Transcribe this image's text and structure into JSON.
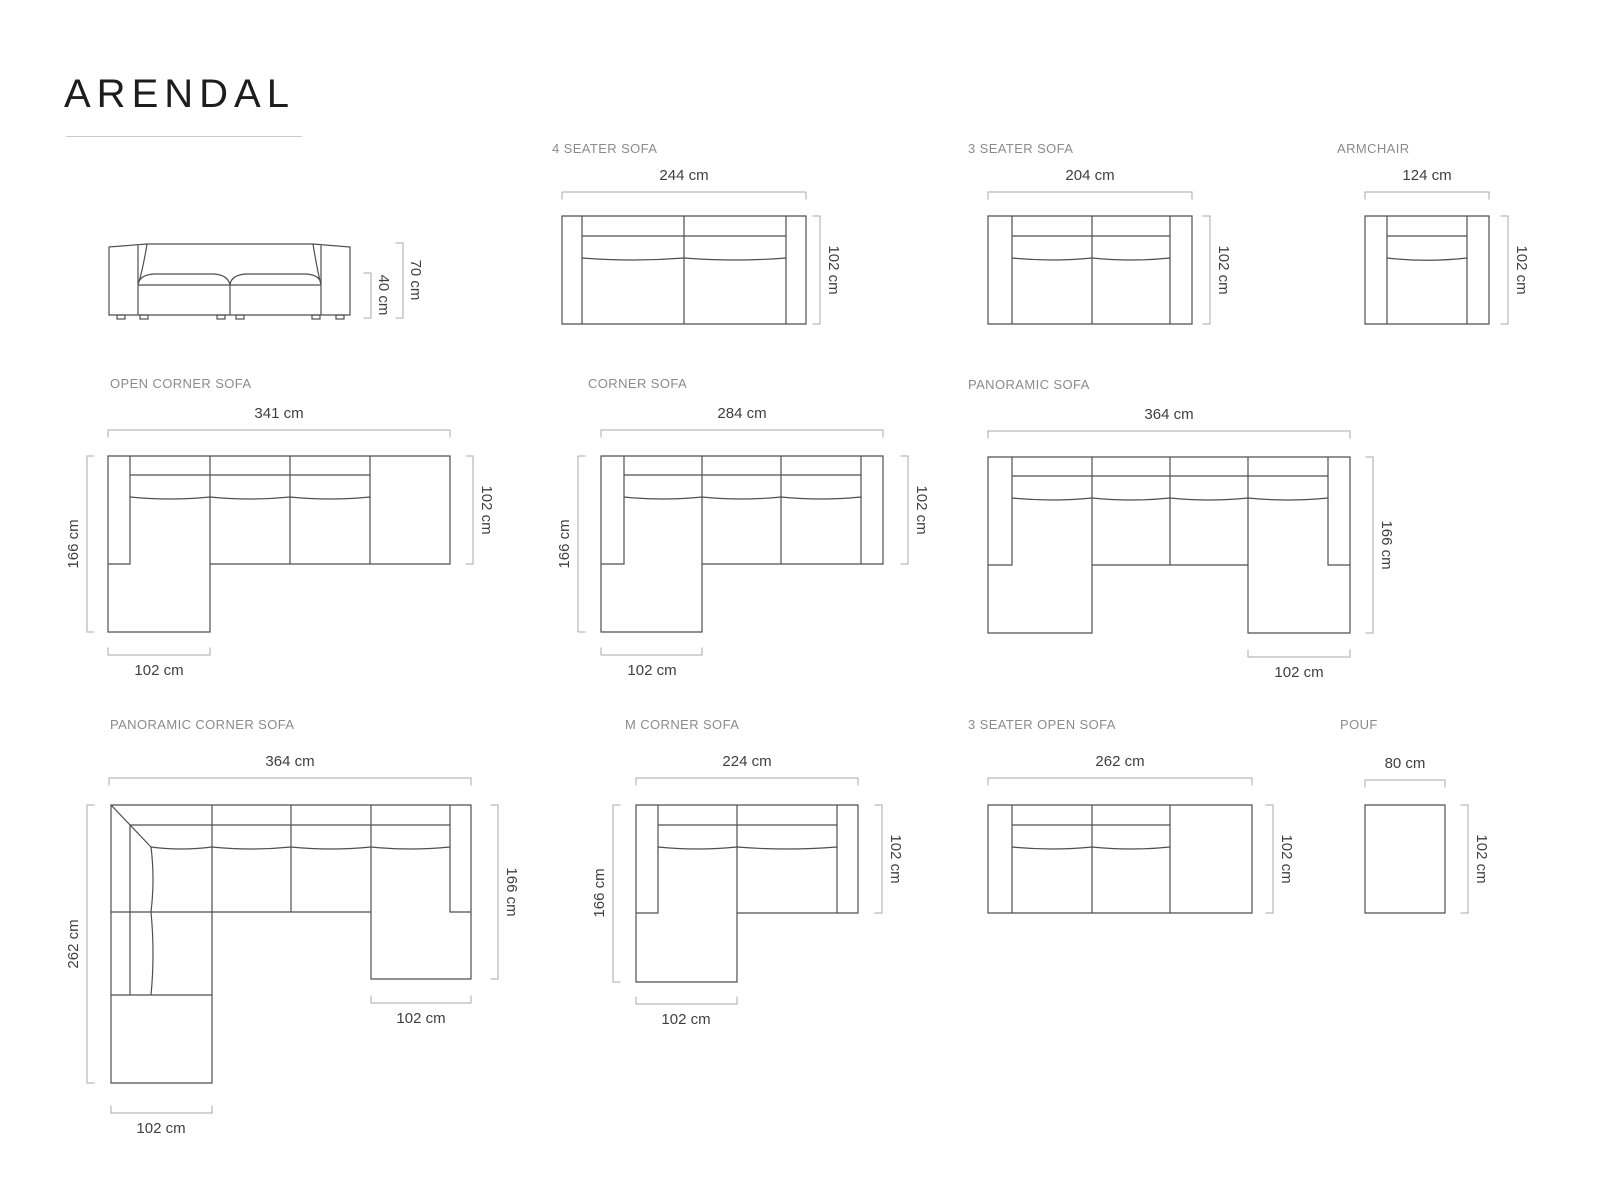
{
  "page_title": "ARENDAL",
  "diagrams": {
    "elevation": {
      "height": "70 cm",
      "seat_height": "40 cm"
    },
    "four_seater": {
      "name": "4 SEATER SOFA",
      "width": "244 cm",
      "depth": "102 cm"
    },
    "three_seater": {
      "name": "3 SEATER SOFA",
      "width": "204 cm",
      "depth": "102 cm"
    },
    "armchair": {
      "name": "ARMCHAIR",
      "width": "124 cm",
      "depth": "102 cm"
    },
    "open_corner": {
      "name": "OPEN CORNER SOFA",
      "width": "341 cm",
      "total_depth": "166 cm",
      "depth": "102 cm",
      "chaise_width": "102 cm"
    },
    "corner": {
      "name": "CORNER SOFA",
      "width": "284 cm",
      "total_depth": "166 cm",
      "depth": "102 cm",
      "chaise_width": "102 cm"
    },
    "panoramic": {
      "name": "PANORAMIC SOFA",
      "width": "364 cm",
      "total_depth": "166 cm",
      "chaise_width": "102 cm"
    },
    "panoramic_corner": {
      "name": "PANORAMIC CORNER SOFA",
      "width": "364 cm",
      "left_depth": "262 cm",
      "right_depth": "166 cm",
      "right_chaise_width": "102 cm",
      "left_chaise_width": "102 cm"
    },
    "m_corner": {
      "name": "M CORNER SOFA",
      "width": "224 cm",
      "total_depth": "166 cm",
      "depth": "102 cm",
      "chaise_width": "102 cm"
    },
    "three_seater_open": {
      "name": "3 SEATER OPEN SOFA",
      "width": "262 cm",
      "depth": "102 cm"
    },
    "pouf": {
      "name": "POUF",
      "width": "80 cm",
      "depth": "102 cm"
    }
  }
}
